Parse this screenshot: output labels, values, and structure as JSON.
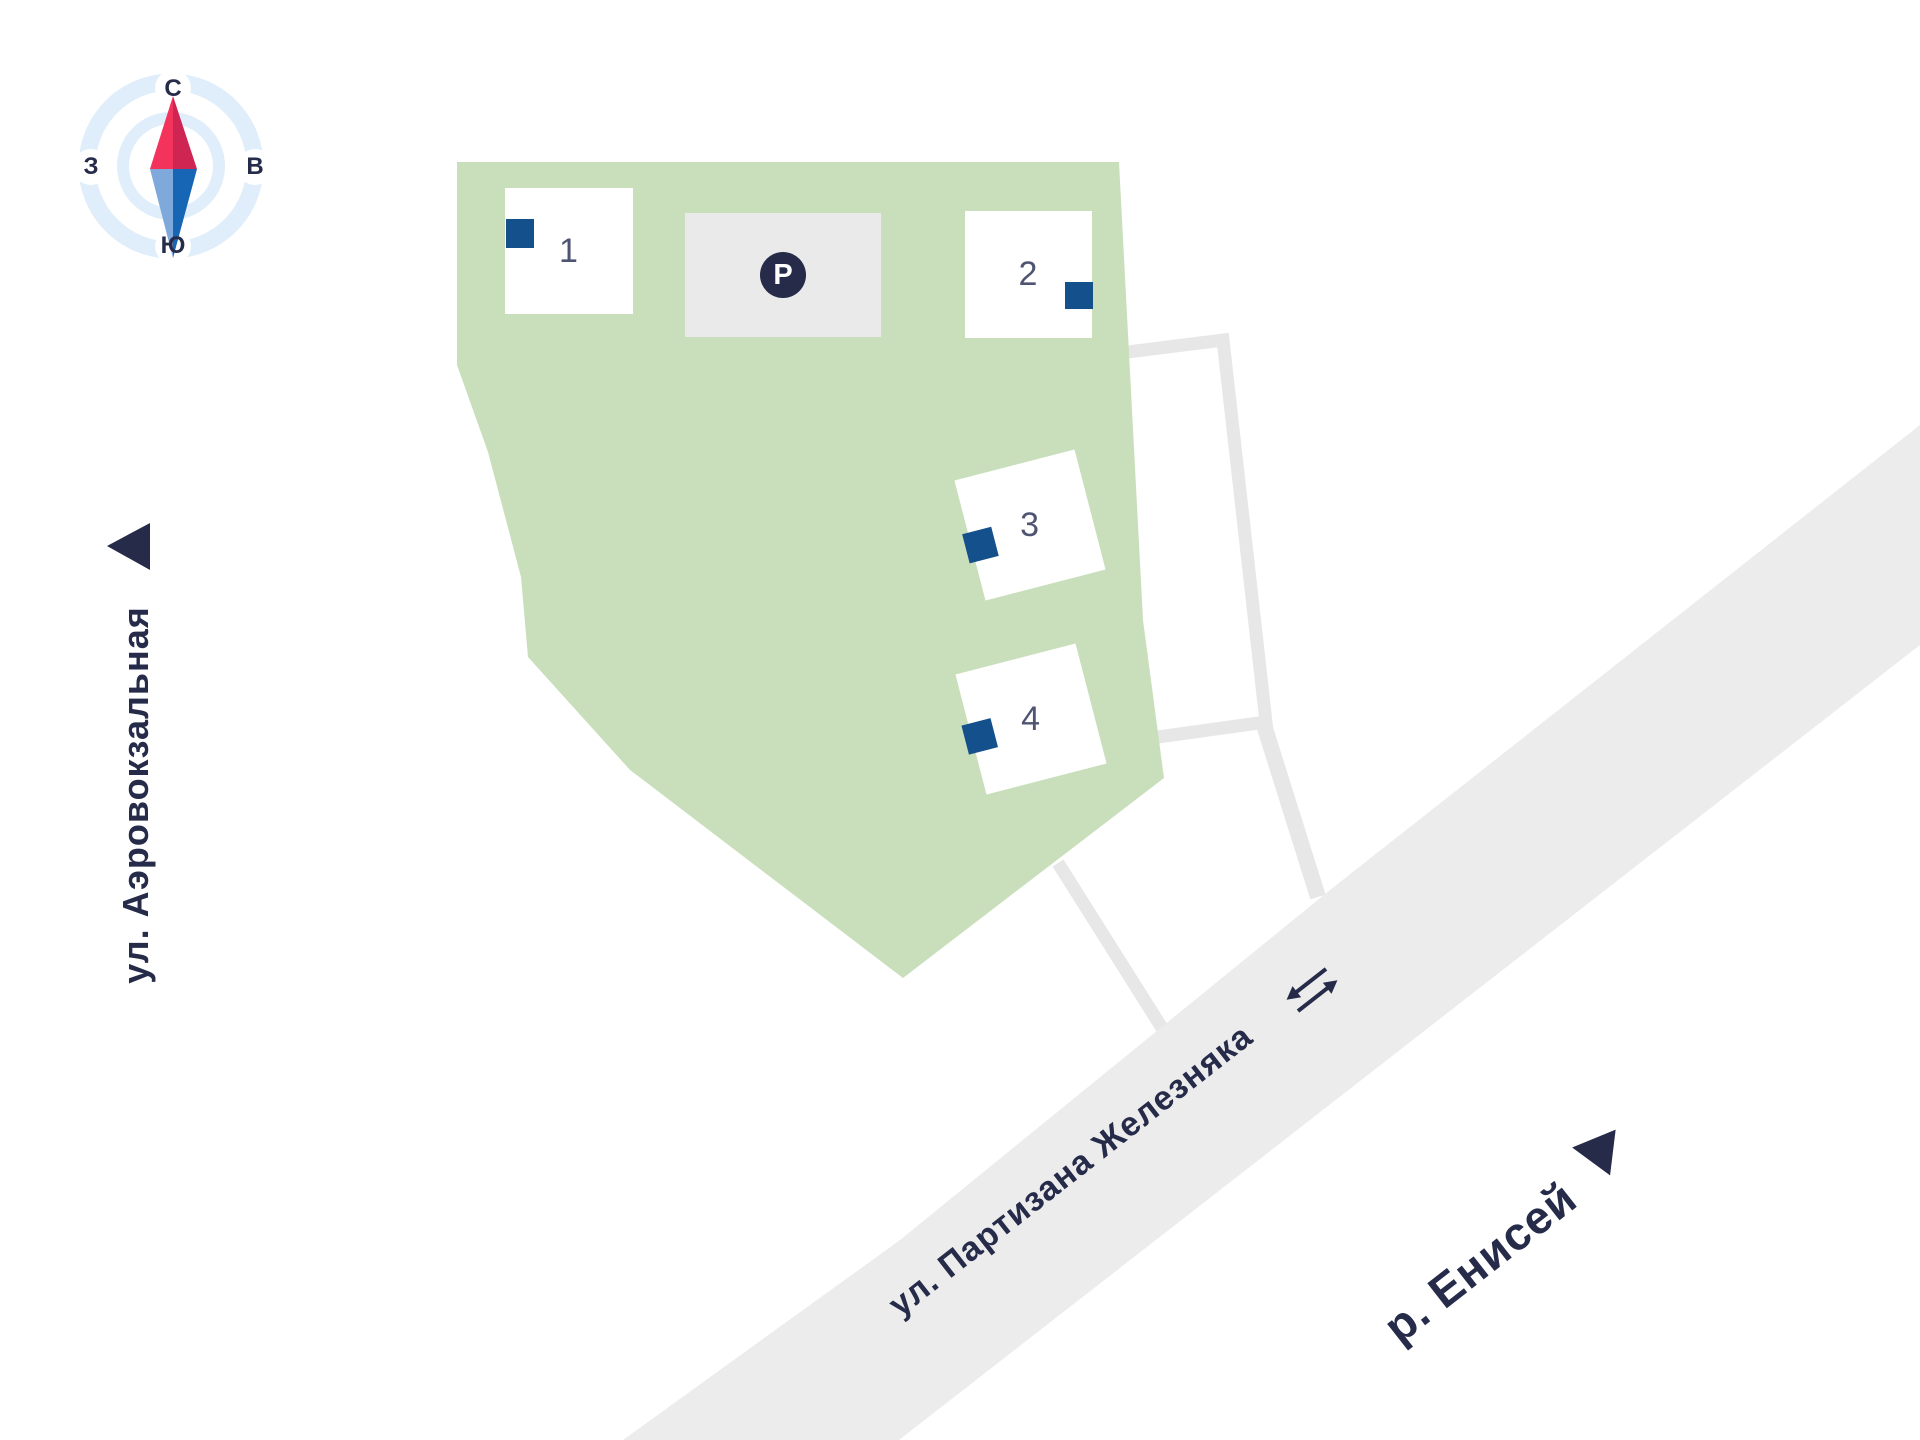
{
  "title": "Residential complex site plan map",
  "compass": {
    "north": "С",
    "south": "Ю",
    "west": "З",
    "east": "В"
  },
  "buildings": [
    {
      "number": "1"
    },
    {
      "number": "2"
    },
    {
      "number": "3"
    },
    {
      "number": "4"
    }
  ],
  "parking": {
    "symbol": "P"
  },
  "streets": {
    "left_street": "ул. Аэровокзальная",
    "road_street": "ул. Партизана Железняка",
    "river": "р. Енисей"
  },
  "colors": {
    "site_green": "#C9DFBB",
    "road_gray": "#ECECEC",
    "road_outline_gray": "#E7E7E7",
    "parking_gray": "#EAEAEA",
    "navy": "#252B49",
    "marker_blue": "#14508C",
    "building_number_gray": "#4E5472",
    "compass_ring_blue": "#DFEEFA",
    "needle_north_light": "#F4335D",
    "needle_north_dark": "#CE2553",
    "needle_south_light": "#7FA9DB",
    "needle_south_dark": "#1766B5"
  }
}
